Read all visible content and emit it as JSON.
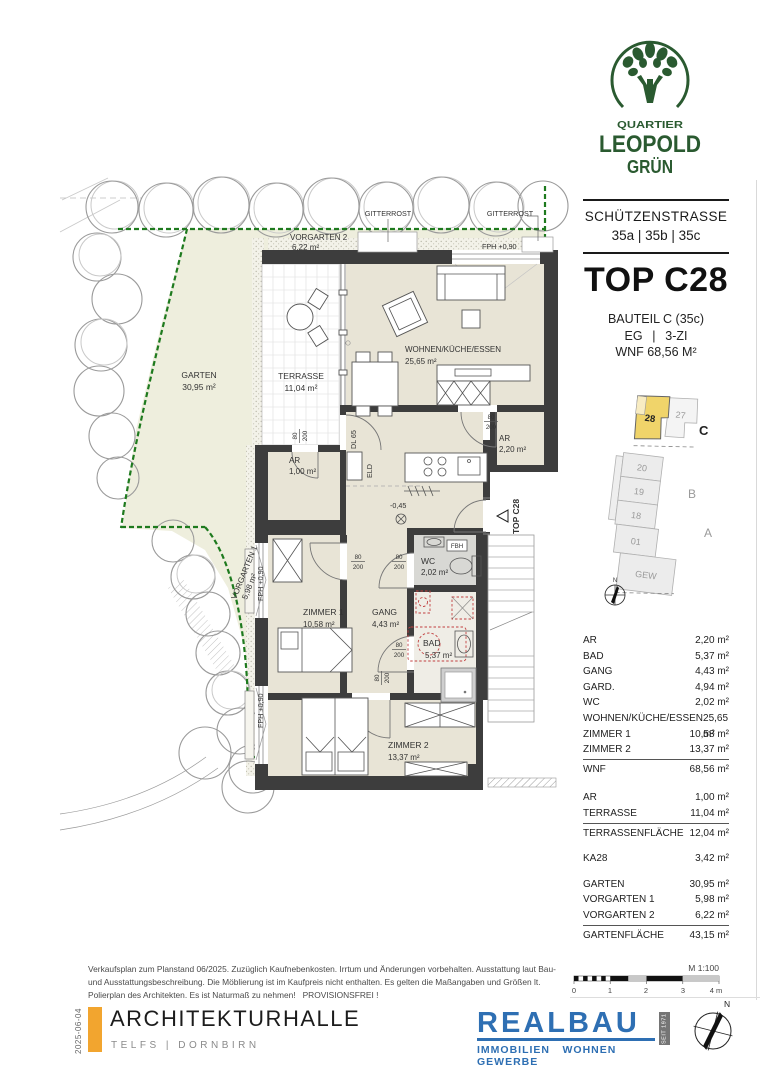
{
  "logo": {
    "quartier": "QUARTIER",
    "leopold": "LEOPOLD",
    "gruen": "GRÜN",
    "color": "#2a5a30"
  },
  "address": {
    "street": "SCHÜTZENSTRASSE",
    "numbers": "35a | 35b | 35c"
  },
  "unit": {
    "title": "TOP C28",
    "building": "BAUTEIL C (35c)",
    "floor": "EG  |  3-ZI",
    "wnf": "WNF 68,56 M²"
  },
  "keyplan": {
    "north": "N",
    "units": {
      "u28": "28",
      "u27": "27",
      "u20": "20",
      "u19": "19",
      "u18": "18",
      "u01": "01",
      "gew": "GEW"
    },
    "sections": {
      "a": "A",
      "b": "B",
      "c": "C"
    },
    "highlight_color": "#f0d46a"
  },
  "area_table": {
    "wnf_rows": [
      [
        "AR",
        "2,20 m²"
      ],
      [
        "BAD",
        "5,37 m²"
      ],
      [
        "GANG",
        "4,43 m²"
      ],
      [
        "GARD.",
        "4,94 m²"
      ],
      [
        "WC",
        "2,02 m²"
      ],
      [
        "WOHNEN/KÜCHE/ESSEN",
        "25,65 m²"
      ],
      [
        "ZIMMER 1",
        "10,58 m²"
      ],
      [
        "ZIMMER 2",
        "13,37 m²"
      ]
    ],
    "wnf_total": [
      "WNF",
      "68,56 m²"
    ],
    "terrasse_rows": [
      [
        "AR",
        "1,00 m²"
      ],
      [
        "TERRASSE",
        "11,04 m²"
      ]
    ],
    "terrasse_total": [
      "TERRASSENFLÄCHE",
      "12,04 m²"
    ],
    "ka_row": [
      "KA28",
      "3,42 m²"
    ],
    "garten_rows": [
      [
        "GARTEN",
        "30,95 m²"
      ],
      [
        "VORGARTEN 1",
        "5,98 m²"
      ],
      [
        "VORGARTEN 2",
        "6,22 m²"
      ]
    ],
    "garten_total": [
      "GARTENFLÄCHE",
      "43,15 m²"
    ]
  },
  "plan": {
    "labels": {
      "gitterrost": "GITTERROST",
      "vorgarten2": "VORGARTEN 2",
      "vorgarten2_area": "6,22 m²",
      "fph": "FPH +0,90",
      "garten": "GARTEN",
      "garten_area": "30,95 m²",
      "terrasse": "TERRASSE",
      "terrasse_area": "11,04 m²",
      "wohnen": "WOHNEN/KÜCHE/ESSEN",
      "wohnen_area": "25,65 m²",
      "ar": "AR",
      "ar1_area": "1,00 m²",
      "ar2_area": "2,20 m²",
      "gang": "GANG",
      "gang_area": "4,43 m²",
      "wc": "WC",
      "wc_area": "2,02 m²",
      "bad": "BAD",
      "bad_area": "5,37 m²",
      "zimmer1": "ZIMMER 1",
      "zimmer1_area": "10,58 m²",
      "zimmer2": "ZIMMER 2",
      "zimmer2_area": "13,37 m²",
      "vorgarten1": "VORGARTEN 1",
      "vorgarten1_area": "5,98 m²",
      "entry": "TOP C28",
      "level": "-0,45",
      "dl": "DL 65",
      "eld": "ELD",
      "fbh": "FBH",
      "door_w": "80",
      "door_h": "200"
    }
  },
  "scalebar": {
    "label": "M 1:100",
    "t0": "0",
    "t1": "1",
    "t2": "2",
    "t3": "3",
    "t4": "4 m"
  },
  "footer": {
    "disclaimer": "Verkaufsplan zum Planstand 06/2025. Zuzüglich Kaufnebenkosten. Irrtum und Änderungen vorbehalten. Ausstattung laut Bau- und Ausstattungsbeschreibung. Die Möblierung ist im Kaufpreis nicht enthalten. Es gelten die Maßangaben und Größen lt. Polierplan des Architekten. Es ist Naturmaß zu nehmen!   PROVISIONSFREI !",
    "date": "2025-06-04",
    "architect": {
      "name": "ARCHITEKTURHALLE",
      "sub": "TELFS | DORNBIRN",
      "bar_color": "#f2a52f"
    },
    "realbau": {
      "name": "REALBAU",
      "sub": "IMMOBILIEN  WOHNEN  GEWERBE",
      "badge": "SEIT 1971",
      "color": "#2e6fb3"
    }
  }
}
